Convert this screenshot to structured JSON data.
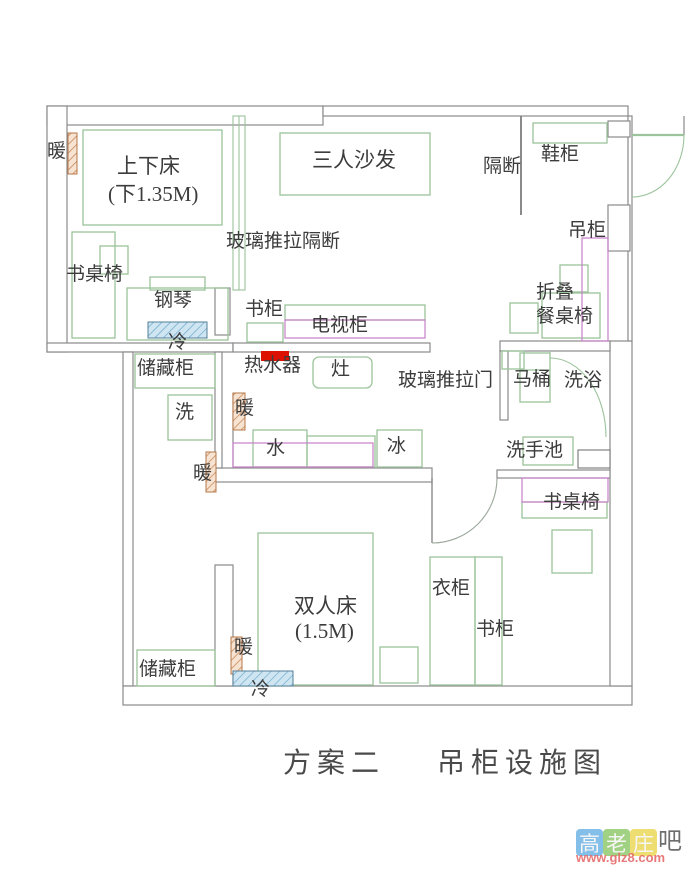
{
  "title": {
    "part1": "方案二",
    "part2": "吊柜设施图"
  },
  "watermark": {
    "chars": [
      {
        "t": "高",
        "c": "#74b7e8"
      },
      {
        "t": "老",
        "c": "#95cc72"
      },
      {
        "t": "庄",
        "c": "#ecd95e"
      }
    ],
    "suffix": "吧",
    "url": "www.glz8.com"
  },
  "colors": {
    "wall_gray": "#8a8a8a",
    "furniture_green": "#9cc39c",
    "hanging_cabinet_magenta": "#c77fc7",
    "water_heater_red": "#dd1100",
    "radiator_orange": "#c98a5a",
    "cold_unit_blue": "#6fa9cc",
    "label_ink": "#3c3c3c"
  },
  "labels": [
    {
      "name": "radiator-label-1",
      "text": "暖",
      "x": 47,
      "y": 142,
      "fs": 19
    },
    {
      "name": "bunk-bed-label",
      "text": "上下床",
      "x": 117,
      "y": 155,
      "fs": 21
    },
    {
      "name": "bunk-bed-size",
      "text": "(下1.35M)",
      "x": 108,
      "y": 183,
      "fs": 21
    },
    {
      "name": "sofa-label",
      "text": "三人沙发",
      "x": 312,
      "y": 149,
      "fs": 21
    },
    {
      "name": "partition-label",
      "text": "隔断",
      "x": 483,
      "y": 157,
      "fs": 19
    },
    {
      "name": "shoe-cabinet-label",
      "text": "鞋柜",
      "x": 541,
      "y": 145,
      "fs": 19
    },
    {
      "name": "glass-partition-label",
      "text": "玻璃推拉隔断",
      "x": 226,
      "y": 232,
      "fs": 19
    },
    {
      "name": "hanging-cabinet-label",
      "text": "吊柜",
      "x": 568,
      "y": 221,
      "fs": 19
    },
    {
      "name": "desk-chair-label-1",
      "text": "书桌椅",
      "x": 66,
      "y": 265,
      "fs": 19
    },
    {
      "name": "piano-label",
      "text": "钢琴",
      "x": 154,
      "y": 291,
      "fs": 19
    },
    {
      "name": "bookcase-label-1",
      "text": "书柜",
      "x": 245,
      "y": 300,
      "fs": 19
    },
    {
      "name": "tv-cabinet-label",
      "text": "电视柜",
      "x": 311,
      "y": 316,
      "fs": 19
    },
    {
      "name": "folding-table-label-1",
      "text": "折叠",
      "x": 536,
      "y": 283,
      "fs": 19
    },
    {
      "name": "folding-table-label-2",
      "text": "餐桌椅",
      "x": 536,
      "y": 307,
      "fs": 19
    },
    {
      "name": "cold-label-1",
      "text": "冷",
      "x": 168,
      "y": 333,
      "fs": 19
    },
    {
      "name": "storage-label-1",
      "text": "储藏柜",
      "x": 137,
      "y": 359,
      "fs": 19
    },
    {
      "name": "water-heater-label",
      "text": "热水器",
      "x": 244,
      "y": 356,
      "fs": 19
    },
    {
      "name": "stove-label",
      "text": "灶",
      "x": 331,
      "y": 360,
      "fs": 19
    },
    {
      "name": "sliding-door-label",
      "text": "玻璃推拉门",
      "x": 398,
      "y": 371,
      "fs": 19
    },
    {
      "name": "toilet-label",
      "text": "马桶",
      "x": 513,
      "y": 370,
      "fs": 19
    },
    {
      "name": "bath-label",
      "text": "洗浴",
      "x": 564,
      "y": 371,
      "fs": 19
    },
    {
      "name": "washer-label",
      "text": "洗",
      "x": 175,
      "y": 403,
      "fs": 19
    },
    {
      "name": "radiator-label-2",
      "text": "暖",
      "x": 235,
      "y": 399,
      "fs": 19
    },
    {
      "name": "sink-label",
      "text": "水",
      "x": 266,
      "y": 439,
      "fs": 19
    },
    {
      "name": "fridge-label",
      "text": "冰",
      "x": 387,
      "y": 437,
      "fs": 19
    },
    {
      "name": "basin-label",
      "text": "洗手池",
      "x": 506,
      "y": 441,
      "fs": 19
    },
    {
      "name": "radiator-label-3",
      "text": "暖",
      "x": 193,
      "y": 464,
      "fs": 19
    },
    {
      "name": "desk-chair-label-2",
      "text": "书桌椅",
      "x": 543,
      "y": 493,
      "fs": 19
    },
    {
      "name": "double-bed-label",
      "text": "双人床",
      "x": 294,
      "y": 595,
      "fs": 21
    },
    {
      "name": "double-bed-size",
      "text": "(1.5M)",
      "x": 295,
      "y": 620,
      "fs": 21
    },
    {
      "name": "wardrobe-label",
      "text": "衣柜",
      "x": 432,
      "y": 579,
      "fs": 19
    },
    {
      "name": "bookcase-label-2",
      "text": "书柜",
      "x": 476,
      "y": 620,
      "fs": 19
    },
    {
      "name": "storage-label-2",
      "text": "储藏柜",
      "x": 139,
      "y": 660,
      "fs": 19
    },
    {
      "name": "radiator-label-4",
      "text": "暖",
      "x": 234,
      "y": 638,
      "fs": 19
    },
    {
      "name": "cold-label-2",
      "text": "冷",
      "x": 251,
      "y": 680,
      "fs": 19
    }
  ]
}
